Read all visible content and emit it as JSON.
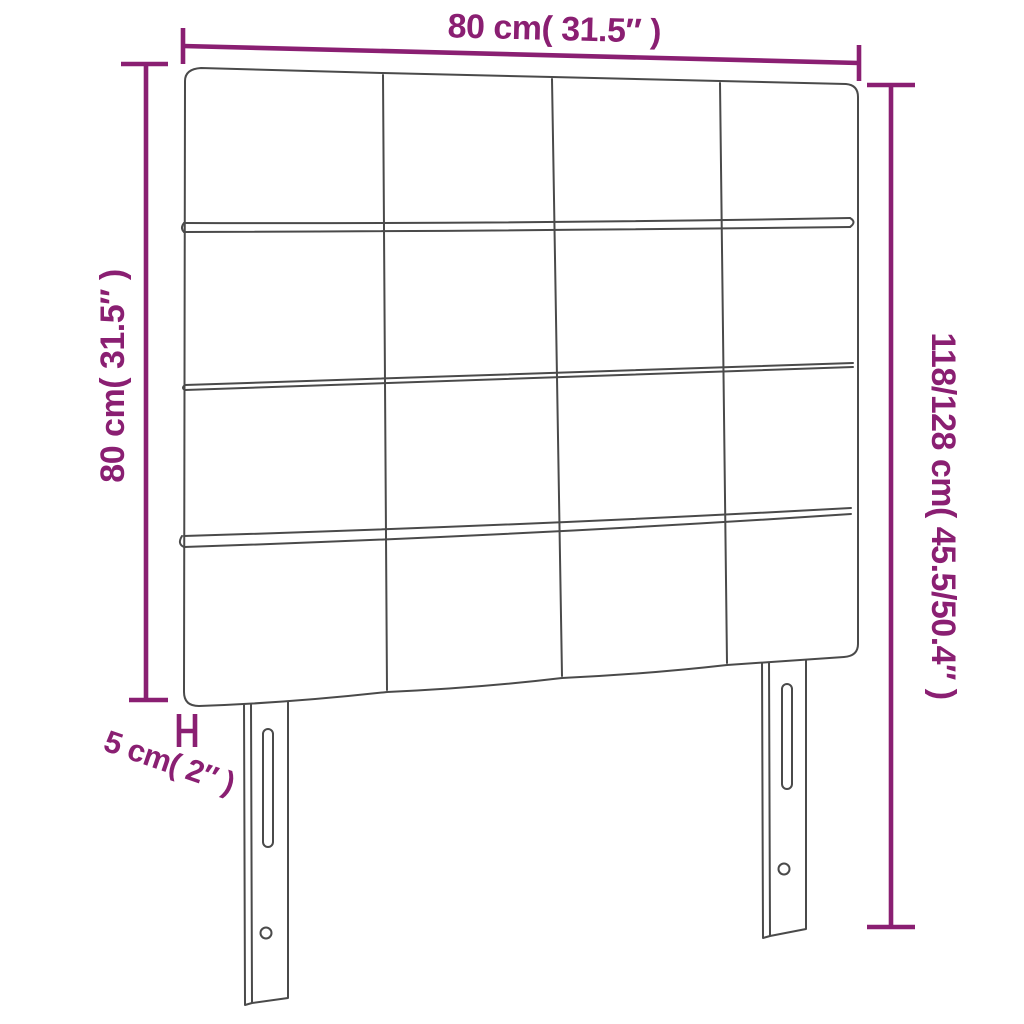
{
  "diagram": {
    "dimensions": {
      "width_top": "80 cm( 31.5″ )",
      "height_left": "80 cm( 31.5″ )",
      "height_right": "118/128 cm( 45.5/50.4″ )",
      "depth_bottom_left": "5 cm( 2″ )"
    },
    "figure": {
      "type": "headboard-front-view",
      "panel_grid": {
        "rows": 4,
        "columns": 4
      },
      "legs": 2,
      "slots_per_leg": 1,
      "screw_holes_per_leg": 1
    },
    "colors": {
      "dimension_accent": "#8A1F72",
      "drawing_line": "#4A4A4A",
      "background": "#FFFFFF"
    }
  }
}
